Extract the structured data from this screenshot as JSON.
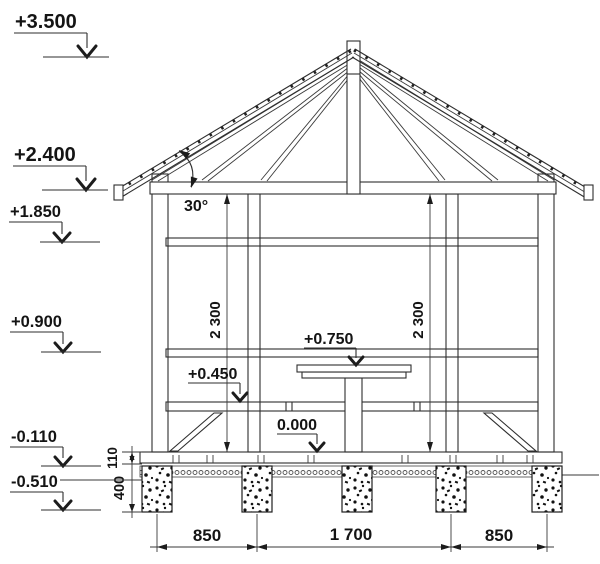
{
  "elevation_markers_left": [
    "+3.500",
    "+2.400",
    "+1.850",
    "+0.900",
    "-0.110",
    "-0.510"
  ],
  "level_markers_interior": [
    "+0.750",
    "+0.450",
    "0.000"
  ],
  "angle_label": "30°",
  "vertical_dimensions": {
    "wall_left": "2 300",
    "wall_right": "2 300",
    "deck_thickness": "110",
    "pier_height": "400"
  },
  "bottom_dimensions": [
    "850",
    "1 700",
    "850"
  ],
  "colors": {
    "line": "#2e2e2e",
    "text": "#141414",
    "background": "#ffffff"
  }
}
